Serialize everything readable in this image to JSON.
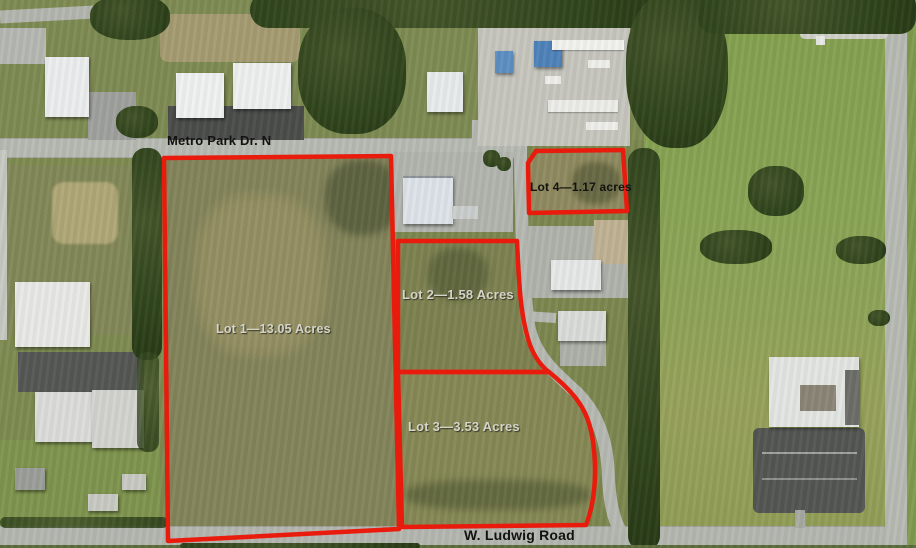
{
  "roads": {
    "top_road_label": "Metro Park Dr. N",
    "bottom_road_label": "W. Ludwig Road"
  },
  "lots": [
    {
      "name": "Lot 1",
      "area": "13.05 Acres",
      "label": "Lot 1—13.05 Acres"
    },
    {
      "name": "Lot 2",
      "area": "1.58 Acres",
      "label": "Lot 2—1.58 Acres"
    },
    {
      "name": "Lot 3",
      "area": "3.53 Acres",
      "label": "Lot 3—3.53 Acres"
    },
    {
      "name": "Lot 4",
      "area": "1.17 acres",
      "label": "Lot 4—1.17 acres"
    }
  ],
  "colors": {
    "lot_boundary": "#e81b0c",
    "label_light": "#d4d4ca",
    "label_dark": "#131210",
    "road_gray": "#b7bab3",
    "field_green": "#87a153",
    "tree_green": "#33471e"
  }
}
